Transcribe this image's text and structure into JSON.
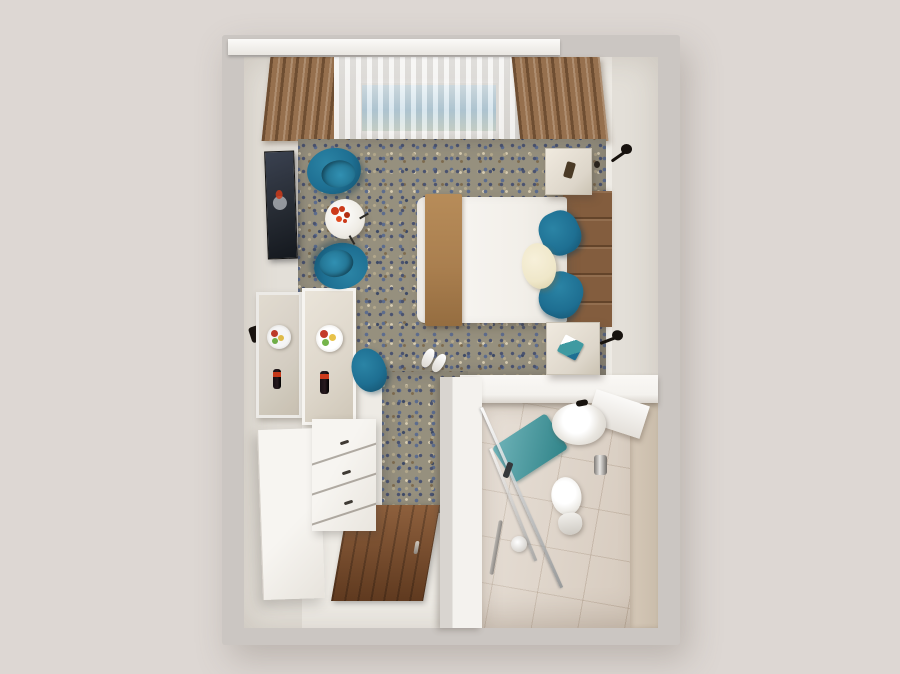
{
  "scene": {
    "type": "3d-room-render",
    "view": "top-down dollhouse perspective",
    "description": "Top-down 3D render of a compact hotel guest room: lounge corner with two teal tub chairs, double bed with camel runner and teal pillows, console desk with fruit plate and wine bottle, wardrobe and chest of drawers, wooden entry door, and an en-suite bathroom with washbasin, toilet, walk-in glass shower and turquoise bath mat.",
    "backdrop_color": "#ddd7d3"
  },
  "colors": {
    "backdrop": "#ddd7d3",
    "outer_wall": "#cbc6c2",
    "inner_wall": "#eeebe5",
    "wall_shade": "#e3dfd8",
    "carpet_base": "#96907e",
    "wood_floor": "#7a4a28",
    "tile_floor": "#ded3c7",
    "bath_wall": "#d5c8b8",
    "partition_white": "#f4f2ee",
    "teal": "#1e6f92",
    "teal_dark": "#14506c",
    "mat_teal": "#3f9aa1",
    "runner": "#aa7f4f",
    "headboard": "#835d3e",
    "drape": "#96704e",
    "sky": "#a9c8da",
    "duvet": "#f6f4f0",
    "white_furniture": "#f4f2ee",
    "marble": "#ddd6ca",
    "tv_dark": "#262b33",
    "lamp_black": "#17120e",
    "flower_red": "#cc3a1a",
    "fruit_red": "#c43c2a",
    "fruit_yellow": "#e8c24a",
    "fruit_green": "#74b44a",
    "bottle_dark": "#271a1e",
    "cream_pillow": "#efe7c9",
    "glass_gray": "#8f9497"
  },
  "objects": {
    "room": {
      "label": "Hotel room (top-down 3D render)"
    },
    "window": {
      "label": "Window with sheer curtain and sky view"
    },
    "pelmet": {
      "label": "White curtain pelmet"
    },
    "drape_left": {
      "label": "Brown drape (left)"
    },
    "drape_right": {
      "label": "Brown drape (right)"
    },
    "carpet": {
      "label": "Patterned blue-beige carpet"
    },
    "tv": {
      "label": "Wall-mounted TV"
    },
    "mirror": {
      "label": "Wall mirror reflecting desk"
    },
    "desk": {
      "label": "Console desk with fruit plate and wine bottle"
    },
    "fruit_plate": {
      "label": "Fruit plate"
    },
    "wine_bottle": {
      "label": "Wine bottle"
    },
    "desk_chair": {
      "label": "Teal desk chair"
    },
    "armchair_1": {
      "label": "Teal tub armchair (upper)"
    },
    "armchair_2": {
      "label": "Teal tub armchair (lower)"
    },
    "coffee_table": {
      "label": "Round side table with red flowers"
    },
    "flowers": {
      "label": "Red flower arrangement"
    },
    "bed": {
      "label": "Double bed with white duvet"
    },
    "runner": {
      "label": "Camel bed runner"
    },
    "pillow_teal": {
      "label": "Teal accent pillow"
    },
    "pillow_cream": {
      "label": "Cream bolster pillow"
    },
    "headboard": {
      "label": "Walnut plank headboard"
    },
    "nightstand_top": {
      "label": "Bedside cabinet (upper) with decor"
    },
    "nightstand_bottom": {
      "label": "Bedside cabinet (lower) with guest directory"
    },
    "brochure": {
      "label": "Guest directory"
    },
    "lamp": {
      "label": "Black wall reading lamp"
    },
    "switch": {
      "label": "Wall switch"
    },
    "slippers": {
      "label": "Hotel slippers"
    },
    "wardrobe": {
      "label": "White wardrobe"
    },
    "dresser": {
      "label": "Chest of drawers"
    },
    "entry_door": {
      "label": "Wooden entry door"
    },
    "partition": {
      "label": "Bathroom partition wall"
    },
    "bathroom_floor": {
      "label": "Beige tiled bathroom floor"
    },
    "bath_wall": {
      "label": "Tiled bathroom wall"
    },
    "bath_door": {
      "label": "Bathroom door (open)"
    },
    "sink": {
      "label": "Washbasin with faucet"
    },
    "toilet": {
      "label": "Toilet"
    },
    "tp_holder": {
      "label": "Toilet paper holder"
    },
    "shower": {
      "label": "Walk-in shower with glass screen"
    },
    "shower_head": {
      "label": "Shower handset"
    },
    "bath_mat": {
      "label": "Turquoise bath mat"
    },
    "wall_hook": {
      "label": "Wall hook"
    }
  }
}
